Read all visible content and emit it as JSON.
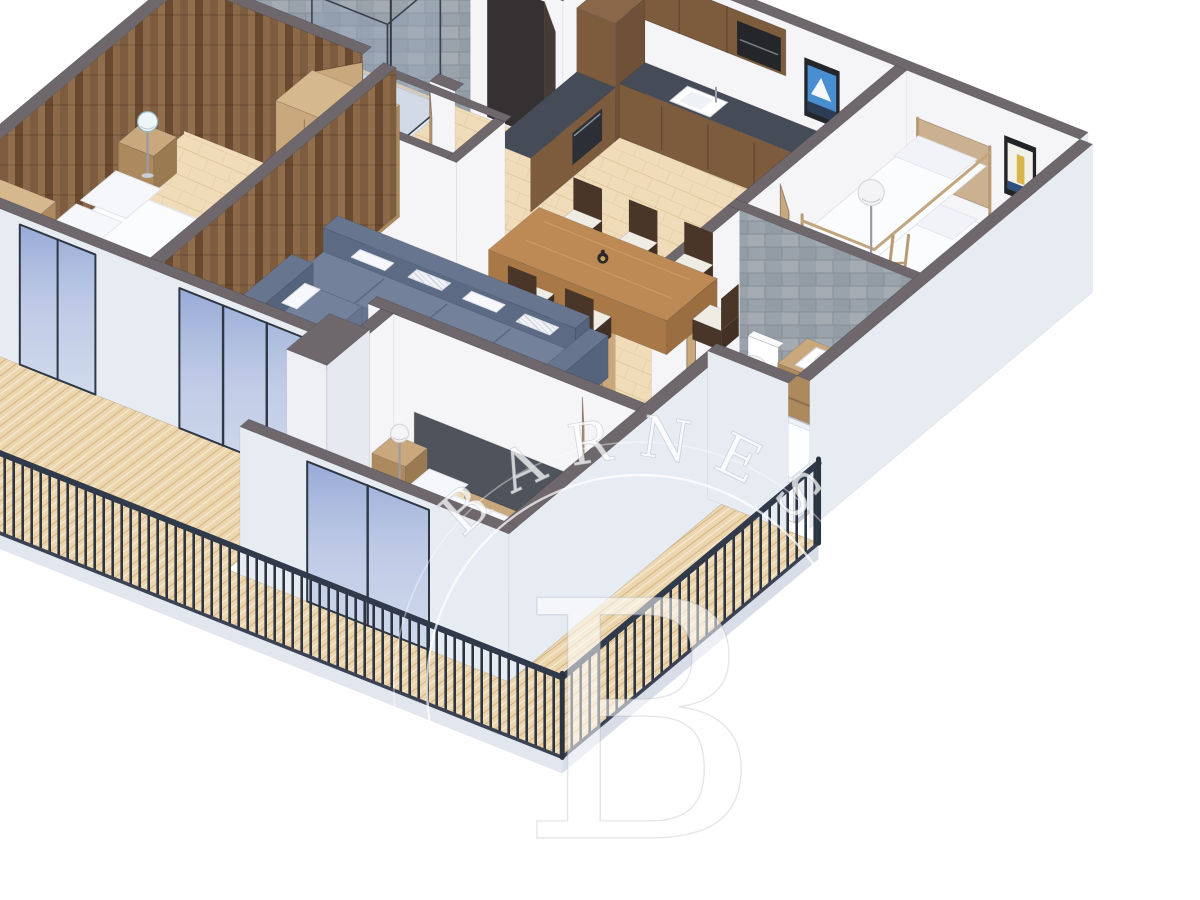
{
  "image": {
    "type": "3d-isometric-floor-plan-render",
    "description": "Photorealistic 3D cutaway floor plan of a chalet-style apartment with wrap-around wooden balcony",
    "background": "#ffffff"
  },
  "watermark": {
    "brand": "BARNES",
    "monogram": "B"
  },
  "palette": {
    "wall_cap": "#6e676c",
    "wall_in": "#f5f5f7",
    "wall_ext": "#e7ebf2",
    "floor_wood": "#f1dcba",
    "floor_line": "#e0c79c",
    "deck_wood": "#ecd6ae",
    "deck_line": "#c8a678",
    "railing": "#2e3745",
    "sofa": "#6f7d96",
    "sofa_dark": "#5c6a83",
    "cabinet_wood": "#7d5c3e",
    "counter": "#454c57",
    "oak": "#c9a87e",
    "oak_dark": "#ad8a5e",
    "rustic_wood": "#7d5c40",
    "tile_gray": "#9aa2ab",
    "glass_blue": "#9db1d8",
    "linen_white": "#fbfcfe",
    "poster_sky_blue": "#4a8ed2",
    "poster_figure_yellow": "#d9b44a",
    "lantern_black": "#2b2a28",
    "door_dark": "#443b37"
  },
  "rooms": [
    {
      "name": "Kitchen",
      "furniture": [
        "L-shaped walnut base cabinets",
        "dark gray countertop",
        "white sink with faucet",
        "built-in oven",
        "upper cabinets with microwave",
        "tall cabinet column",
        "framed mountain poster",
        "floor lamp"
      ]
    },
    {
      "name": "Dining area",
      "furniture": [
        "rectangular wood dining table",
        "six dark wood chairs with white cushions",
        "black candle lantern centerpiece"
      ]
    },
    {
      "name": "Living room",
      "furniture": [
        "gray L-shaped sectional sofa",
        "white and patterned throw pillows",
        "wood coffee table with book and lantern",
        "floor lamp with white shade",
        "oak sideboard with lantern",
        "rustic plank accent wall"
      ]
    },
    {
      "name": "Master bedroom",
      "furniture": [
        "double bed with white duvet",
        "rustic wood plank headboard wall",
        "two nightstands with table lamps",
        "two oak wardrobes",
        "sliding glass door to balcony"
      ]
    },
    {
      "name": "Bunk bedroom",
      "furniture": [
        "wooden bunk bed with ladder",
        "white mattresses and pillows",
        "framed giraffe poster",
        "floor lamp"
      ]
    },
    {
      "name": "Bathroom",
      "furniture": [
        "gray tiled wall",
        "wall-hung toilet",
        "oak vanity with white vessel sink",
        "built-in bathtub",
        "gray tile floor"
      ]
    },
    {
      "name": "Second bedroom",
      "furniture": [
        "bed with gray upholstered headboard",
        "white duvet and pillows",
        "nightstand with lamp",
        "black floor lantern",
        "open wood door",
        "sliding glass door to balcony"
      ]
    },
    {
      "name": "Shower room",
      "furniture": [
        "gray stone tiled walls",
        "black-framed glass walk-in shower",
        "shower fixture"
      ]
    },
    {
      "name": "Entry hall",
      "furniture": [
        "dark entry door (open)",
        "white partition room with gray wall caps",
        "open oak interior doors"
      ]
    },
    {
      "name": "Balcony",
      "furniture": [
        "light wood plank decking",
        "black metal railing with vertical balusters",
        "blue-tinted sliding glass doors"
      ]
    }
  ]
}
